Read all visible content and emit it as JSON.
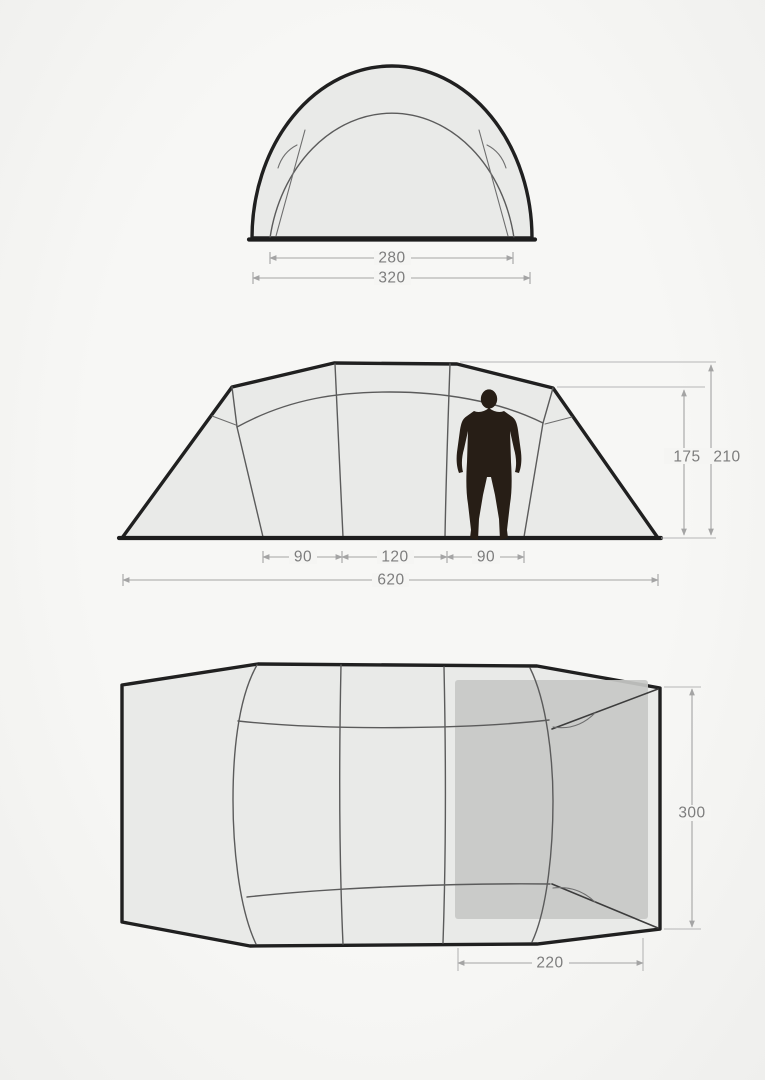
{
  "title": "Tent dimensions three-view diagram",
  "colors": {
    "background": "#f5f5f3",
    "tent_fill": "#e9eae8",
    "cabin_fill": "#c7c8c6",
    "outline": "#202020",
    "dimension_line": "#a4a4a4",
    "dimension_text": "#7d7d7d",
    "figure": "#271e16"
  },
  "views": {
    "front": {
      "name": "front-view",
      "dimensions": [
        {
          "id": "inner-width",
          "label": "280"
        },
        {
          "id": "outer-width",
          "label": "320"
        }
      ]
    },
    "side": {
      "name": "side-view",
      "dimensions": [
        {
          "id": "inner-height",
          "label": "175"
        },
        {
          "id": "peak-height",
          "label": "210"
        },
        {
          "id": "left-room-depth",
          "label": "90"
        },
        {
          "id": "center-section-depth",
          "label": "120"
        },
        {
          "id": "right-room-depth",
          "label": "90"
        },
        {
          "id": "total-length",
          "label": "620"
        }
      ]
    },
    "top": {
      "name": "top-view",
      "dimensions": [
        {
          "id": "tent-width",
          "label": "300"
        },
        {
          "id": "sleeping-cabin-length",
          "label": "220"
        }
      ]
    }
  }
}
